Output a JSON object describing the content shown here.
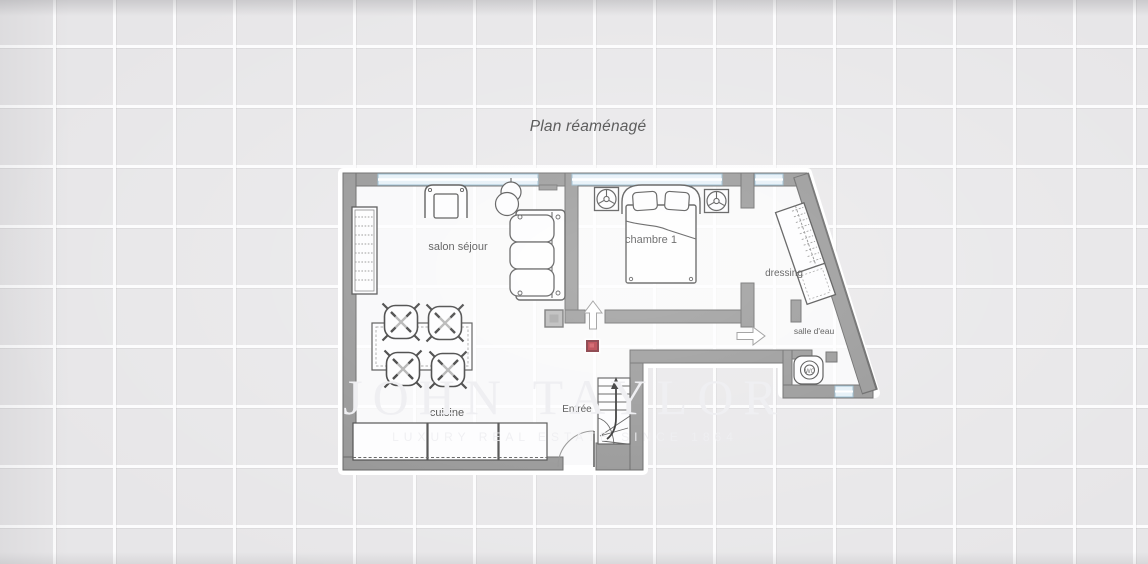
{
  "title": "Plan réaménagé",
  "labels": {
    "living_room": "salon séjour",
    "bedroom": "chambre 1",
    "dressing": "dressing",
    "bathroom": "salle d'eau",
    "kitchen": "cuisine",
    "entrance": "Entrée",
    "wc": "WC"
  },
  "watermark": {
    "brand": "JOHN TAYLOR",
    "tagline": "LUXURY REAL ESTATE SINCE 1864"
  },
  "colors": {
    "tile_background": "#e7e6e8",
    "grout": "#fcfcfd",
    "wall_fill": "#8e8e8e",
    "wall_edge": "#5a5a5a",
    "window_blue": "#e3eff7",
    "window_line": "#8fb6cc",
    "floor": "rgba(255,255,255,0.72)",
    "furniture_line": "#3f3f3f",
    "marker_red": "#ad2430",
    "label_text": "#3c3c3c",
    "watermark": "#efeff2"
  },
  "icons": {
    "furniture": [
      "bookshelf-icon",
      "armchair-icon",
      "floor-lamp-icon",
      "sofa-icon",
      "double-bed-icon",
      "nightstand-icon",
      "wardrobe-icon",
      "toilet-icon",
      "dining-table-icon",
      "chair-icon",
      "kitchen-counter-icon",
      "stairs-icon",
      "door-swing-icon",
      "door-direction-arrow-icon",
      "column-icon",
      "position-marker-icon"
    ]
  }
}
